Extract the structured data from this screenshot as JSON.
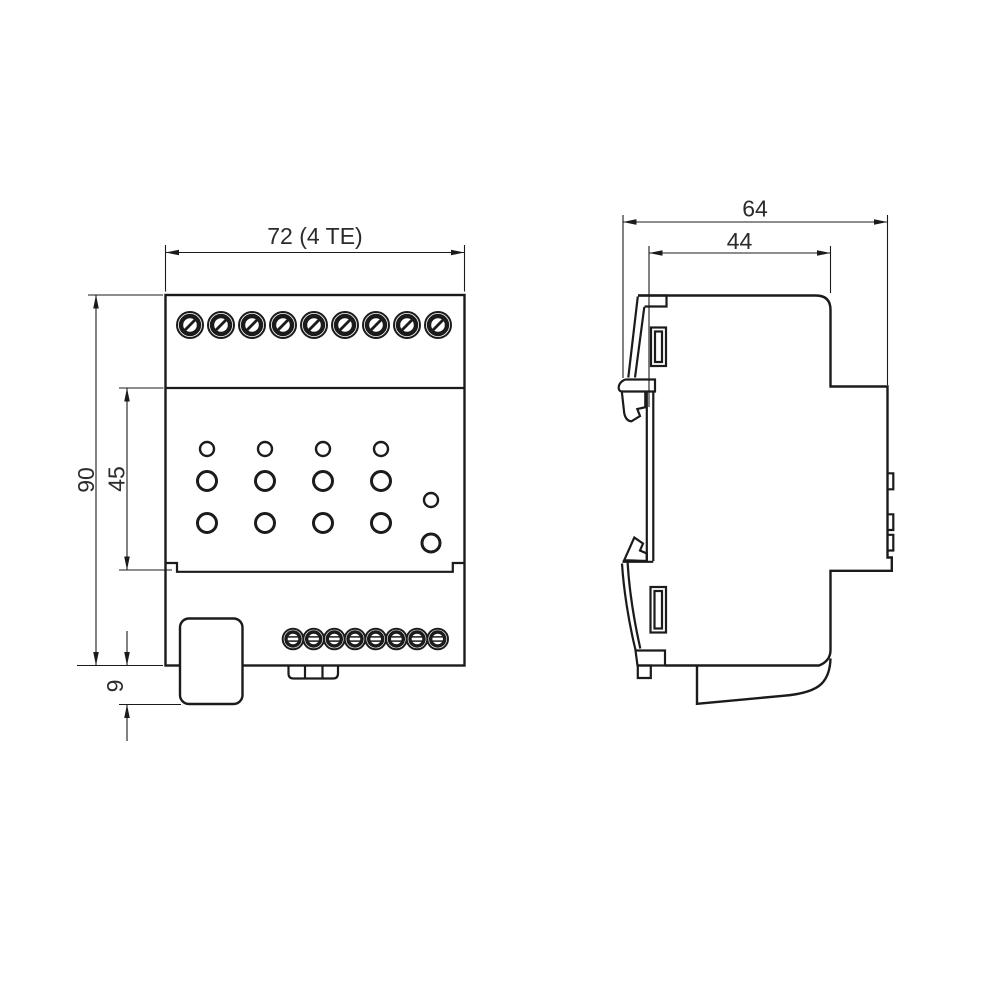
{
  "drawing": {
    "type": "dimensional-drawing",
    "subject": "DIN-rail device, front and side views",
    "front_view": {
      "width_dim": "72 (4 TE)",
      "height_dim": "90",
      "recess_height_dim": "45",
      "protrusion_dim": "9",
      "top_terminal_count": 9,
      "bottom_terminal_count": 8,
      "led_columns": 4,
      "led_rows": 3,
      "aux_led_count": 2
    },
    "side_view": {
      "total_depth_dim": "64",
      "upper_depth_dim": "44"
    },
    "colors": {
      "line": "#1b1b1b",
      "label": "#2b2b2b",
      "background": "#ffffff"
    }
  },
  "geometry": {
    "top_screws": {
      "count": 9,
      "cx0": 190,
      "dx": 31,
      "cy": 325,
      "r_outer": 13,
      "r_ring": 9,
      "slash": 4.7
    },
    "bottom_screws": {
      "count": 8,
      "cx0": 293,
      "dx": 20.67,
      "cy": 639,
      "r_outer": 10.3,
      "r_ring": 7,
      "slot_dy": 2.1,
      "slot_dx": 5.2
    },
    "led_cols": [
      207,
      265,
      323,
      381
    ],
    "led_rows": [
      {
        "cy": 449,
        "r": 7,
        "sw": 2.4
      },
      {
        "cy": 481,
        "r": 9.5,
        "sw": 3
      },
      {
        "cy": 523,
        "r": 9.5,
        "sw": 3
      }
    ],
    "aux_leds": [
      {
        "cx": 431,
        "cy": 500,
        "r": 7,
        "sw": 2.4
      },
      {
        "cx": 431,
        "cy": 543,
        "r": 9,
        "sw": 3
      }
    ],
    "arrows": [
      {
        "x": 165.5,
        "y": 252.5,
        "dir": "left"
      },
      {
        "x": 464.5,
        "y": 252.5,
        "dir": "right"
      },
      {
        "x": 96,
        "y": 295,
        "dir": "up"
      },
      {
        "x": 96,
        "y": 665.5,
        "dir": "down"
      },
      {
        "x": 127,
        "y": 388,
        "dir": "up"
      },
      {
        "x": 127,
        "y": 570,
        "dir": "down"
      },
      {
        "x": 127,
        "y": 665.5,
        "dir": "down"
      },
      {
        "x": 127,
        "y": 704.5,
        "dir": "up"
      },
      {
        "x": 623,
        "y": 222,
        "dir": "left"
      },
      {
        "x": 887.5,
        "y": 222,
        "dir": "right"
      },
      {
        "x": 649,
        "y": 253,
        "dir": "left"
      },
      {
        "x": 830.5,
        "y": 253,
        "dir": "right"
      }
    ]
  }
}
